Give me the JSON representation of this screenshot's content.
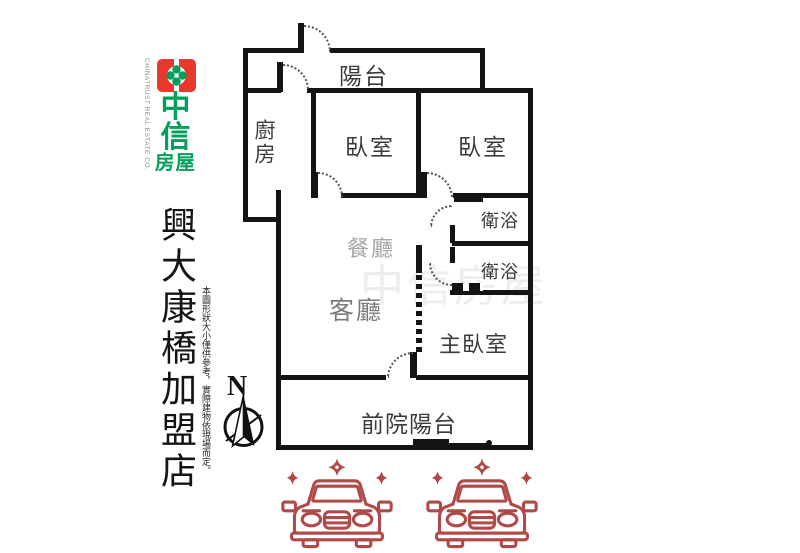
{
  "branding": {
    "company_en": "CHINATRUST REAL ESTATE CO.",
    "logo_char_1": "中",
    "logo_char_2": "信",
    "logo_word": "房屋",
    "store_name": "興大康橋加盟店",
    "disclaimer": "本圖形狀大小僅供參考，實際建物依現場而定。",
    "colors": {
      "logo_red": "#e8382d",
      "logo_green": "#00a05a"
    }
  },
  "compass": {
    "north_label": "N"
  },
  "floorplan": {
    "watermark": "中信房屋",
    "wall_color": "#141414",
    "rooms": [
      {
        "id": "balcony",
        "label": "陽台"
      },
      {
        "id": "kitchen",
        "label": "廚房"
      },
      {
        "id": "bedroom-1",
        "label": "臥室"
      },
      {
        "id": "bedroom-2",
        "label": "臥室"
      },
      {
        "id": "bathroom-1",
        "label": "衛浴"
      },
      {
        "id": "bathroom-2",
        "label": "衛浴"
      },
      {
        "id": "dining-room",
        "label": "餐廳"
      },
      {
        "id": "living-room",
        "label": "客廳"
      },
      {
        "id": "master-bedroom",
        "label": "主臥室"
      },
      {
        "id": "front-yard-balcony",
        "label": "前院陽台"
      }
    ]
  },
  "parking": {
    "car_count": 2,
    "car_color": "#b04a48"
  }
}
